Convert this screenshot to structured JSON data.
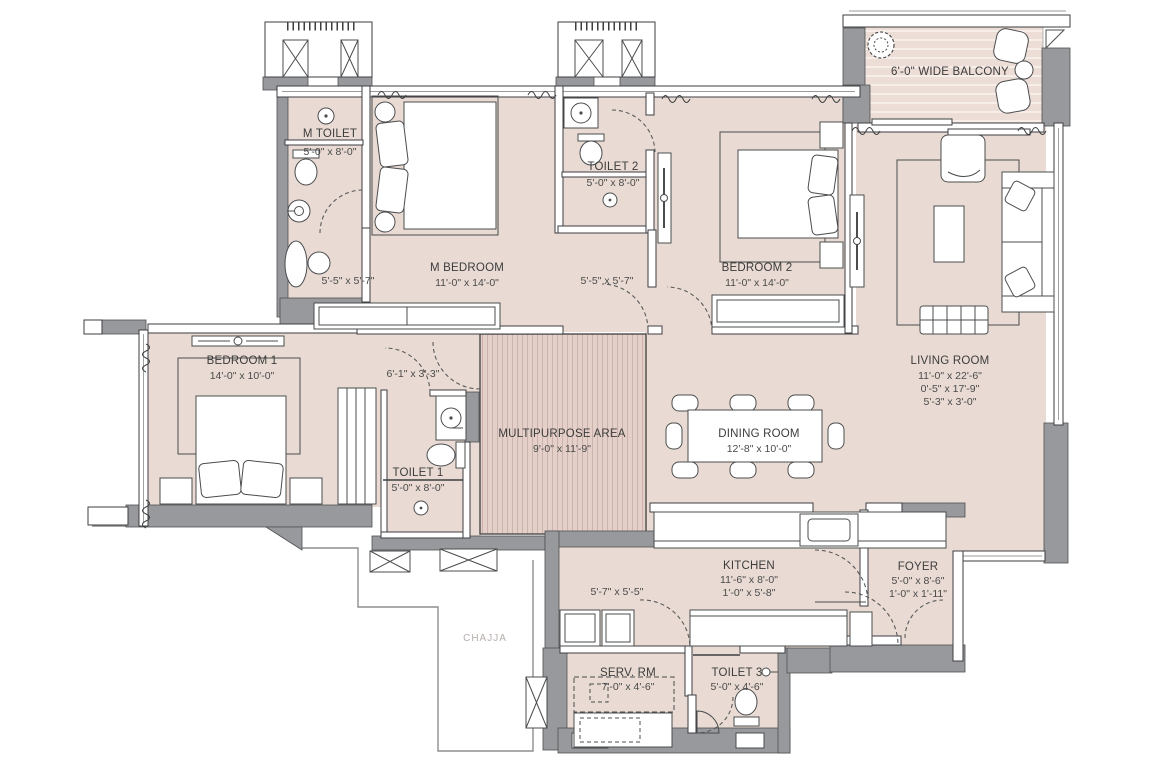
{
  "title": "Apartment Floor Plan",
  "colors": {
    "floor": "#e9dbd4",
    "multipurpose_stripe": "#c9b3ac",
    "wall_gray": "#97999c",
    "outline": "#3d3e40",
    "label_text": "#3c3c3c",
    "chajja_text": "#b5aeab"
  },
  "rooms": {
    "m_toilet": {
      "label": "M TOILET",
      "dims": "5'-0\" x 8'-0\""
    },
    "m_dress": {
      "dims": "5'-5\" x 5'-7\""
    },
    "m_bedroom": {
      "label": "M BEDROOM",
      "dims": "11'-0\" x 14'-0\""
    },
    "toilet2": {
      "label": "TOILET 2",
      "dims": "5'-0\" x 8'-0\""
    },
    "dress2": {
      "dims": "5'-5\" x 5'-7\""
    },
    "bedroom2": {
      "label": "BEDROOM 2",
      "dims": "11'-0\" x 14'-0\""
    },
    "balcony": {
      "label": "6'-0\" WIDE BALCONY"
    },
    "living": {
      "label": "LIVING ROOM",
      "dims": "11'-0\" x 22'-6\"",
      "dims2": "0'-5\" x 17'-9\"",
      "dims3": "5'-3\" x 3'-0\""
    },
    "bedroom1": {
      "label": "BEDROOM 1",
      "dims": "14'-0\" x 10'-0\""
    },
    "passage": {
      "dims": "6'-1\" x 3'-3\""
    },
    "toilet1": {
      "label": "TOILET 1",
      "dims": "5'-0\" x 8'-0\""
    },
    "multipurpose": {
      "label": "MULTIPURPOSE AREA",
      "dims": "9'-0\" x 11'-9\""
    },
    "dining": {
      "label": "DINING ROOM",
      "dims": "12'-8\" x 10'-0\""
    },
    "kitchen": {
      "label": "KITCHEN",
      "dims": "11'-6\" x 8'-0\"",
      "dims2": "1'-0\" x 5'-8\""
    },
    "kitchen_pass": {
      "dims": "5'-7\" x 5'-5\""
    },
    "foyer": {
      "label": "FOYER",
      "dims": "5'-0\" x 8'-6\"",
      "dims2": "1'-0\" x 1'-11\""
    },
    "serv_rm": {
      "label": "SERV. RM",
      "dims": "7'-0\" x 4'-6\""
    },
    "toilet3": {
      "label": "TOILET 3",
      "dims": "5'-0\" x 4'-6\""
    },
    "chajja": {
      "label": "CHAJJA"
    }
  }
}
